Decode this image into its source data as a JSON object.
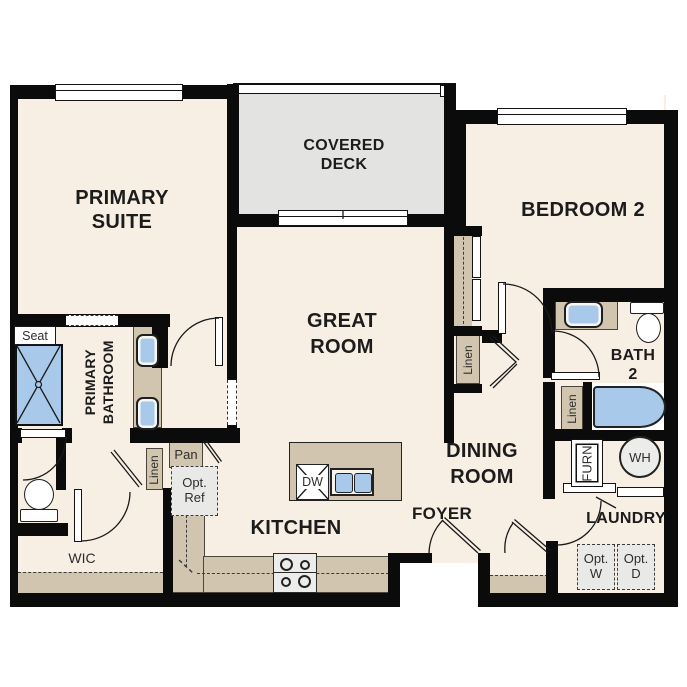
{
  "plan_title": "Residential unit floor plan",
  "rooms": {
    "primary_suite_1": "PRIMARY",
    "primary_suite_2": "SUITE",
    "covered_deck_1": "COVERED",
    "covered_deck_2": "DECK",
    "bedroom2": "BEDROOM 2",
    "great_room_1": "GREAT",
    "great_room_2": "ROOM",
    "dining_1": "DINING",
    "dining_2": "ROOM",
    "kitchen": "KITCHEN",
    "foyer": "FOYER",
    "laundry": "LAUNDRY",
    "bath2_1": "BATH",
    "bath2_2": "2",
    "primary_bath": "PRIMARY BATHROOM",
    "wic": "WIC"
  },
  "features": {
    "seat": "Seat",
    "linen": "Linen",
    "pan": "Pan",
    "opt_ref_1": "Opt.",
    "opt_ref_2": "Ref",
    "dw": "DW",
    "furn": "FURN",
    "wh": "WH",
    "opt_w_1": "Opt.",
    "opt_w_2": "W",
    "opt_d_1": "Opt.",
    "opt_d_2": "D"
  },
  "colors": {
    "wall": "#0b0b0b",
    "floor": "#f7efe3",
    "deck": "#e3e3e1",
    "cabinet_tan": "#d1c5af",
    "fixture_blue": "#a8c9e9",
    "optional_gray": "#e9e9e7"
  }
}
